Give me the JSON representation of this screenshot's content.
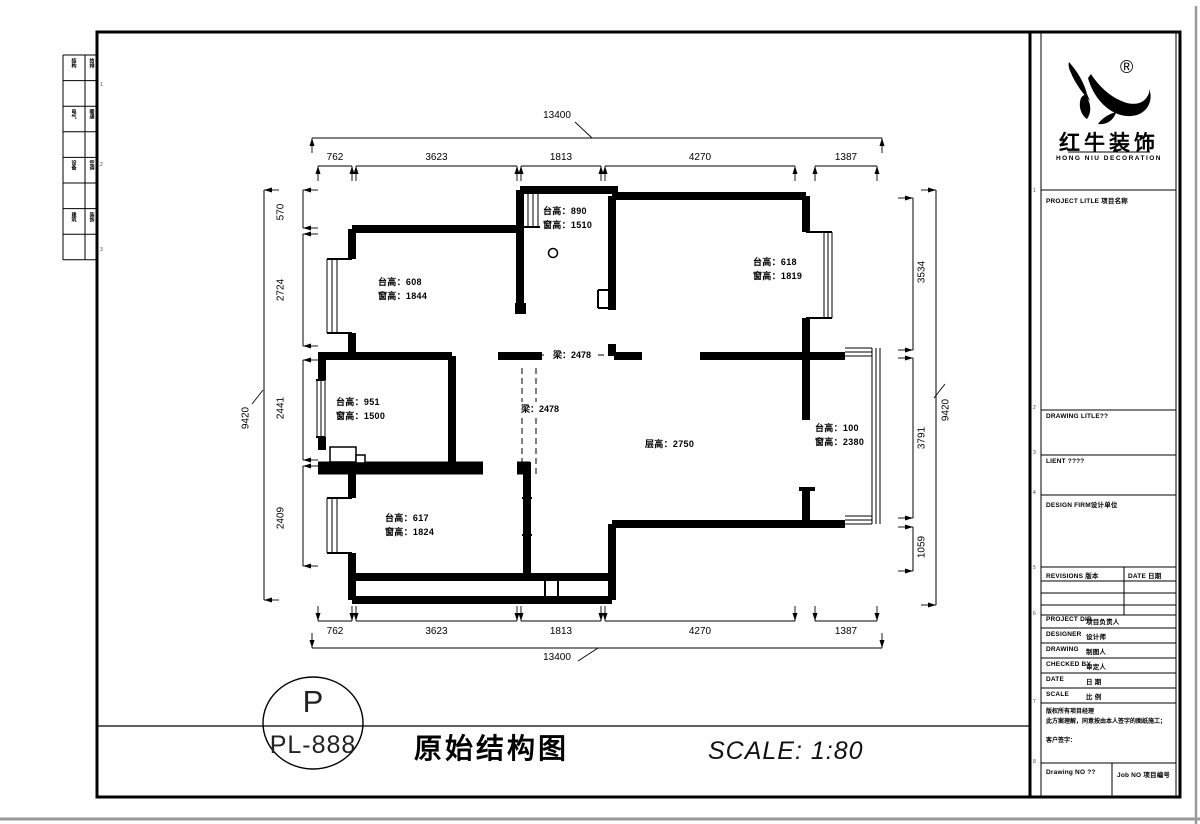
{
  "stamp": {
    "letter": "P",
    "code": "PL-888"
  },
  "sheet": {
    "title": "原始结构图",
    "scale_note": "SCALE: 1:80"
  },
  "plan": {
    "rooms": [
      {
        "id": "room-top-left",
        "lines": [
          "台高：608",
          "窗高：1844"
        ]
      },
      {
        "id": "room-kitchen",
        "lines": [
          "台高：890",
          "窗高：1510"
        ]
      },
      {
        "id": "room-top-right",
        "lines": [
          "台高：618",
          "窗高：1819"
        ]
      },
      {
        "id": "room-mid-left",
        "lines": [
          "台高：951",
          "窗高：1500"
        ]
      },
      {
        "id": "room-low-left",
        "lines": [
          "台高：617",
          "窗高：1824"
        ]
      },
      {
        "id": "living-room",
        "lines": [
          "层高：2750"
        ]
      },
      {
        "id": "balcony",
        "lines": [
          "台高：100",
          "窗高：2380"
        ]
      }
    ],
    "beams": [
      {
        "id": "beam-horizontal",
        "label": "梁：2478"
      },
      {
        "id": "beam-vertical",
        "label": "梁：2478"
      }
    ],
    "dims": {
      "top": {
        "total": "13400",
        "segments": [
          "762",
          "3623",
          "1813",
          "4270",
          "1387"
        ]
      },
      "bottom": {
        "total": "13400",
        "segments": [
          "762",
          "3623",
          "1813",
          "4270",
          "1387"
        ]
      },
      "left": {
        "total": "9420",
        "segments": [
          "570",
          "2724",
          "2441",
          "2409"
        ]
      },
      "right": {
        "total": "9420",
        "segments": [
          "3534",
          "3791",
          "1059"
        ]
      }
    }
  },
  "titleblock": {
    "logo": {
      "reg": "®",
      "name": "红牛装饰",
      "sub": "HONG NIU DECORATION"
    },
    "project_label": "PROJECT LITLE 项目名称",
    "drawing_label": "DRAWING LITLE??",
    "client_label": "LIENT ????",
    "firm_label": "DESIGN FIRM设计单位",
    "revisions_label": "REVISIONS 版本",
    "rev_date_label": "DATE 日期",
    "rows": [
      {
        "en": "PROJECT DIR.",
        "cn": "项目负责人"
      },
      {
        "en": "DESIGNER",
        "cn": "设计师"
      },
      {
        "en": "DRAWING",
        "cn": "制图人"
      },
      {
        "en": "CHECKED BY",
        "cn": "审定人"
      },
      {
        "en": "DATE",
        "cn": "日 期"
      },
      {
        "en": "SCALE",
        "cn": "比 例"
      }
    ],
    "copyright": [
      "版权所有项目经理",
      "此方案理解，同意按由本人签字的图纸施工；",
      "客户签字："
    ],
    "drawing_no_label": "Drawing NO ??",
    "job_no_label": "Job NO 项目编号"
  },
  "strip": {
    "rows": [
      [
        "结构",
        "给排"
      ],
      [
        "电气",
        "暖通"
      ],
      [
        "设备",
        "空调"
      ],
      [
        "建筑",
        "装饰"
      ]
    ],
    "marks": [
      "1",
      "2",
      "3"
    ]
  },
  "frame_marks": [
    "1",
    "2",
    "3",
    "4",
    "5",
    "6",
    "7",
    "8"
  ],
  "colors": {
    "line": "#000000",
    "edge_shadow": "#9a9a9a"
  }
}
